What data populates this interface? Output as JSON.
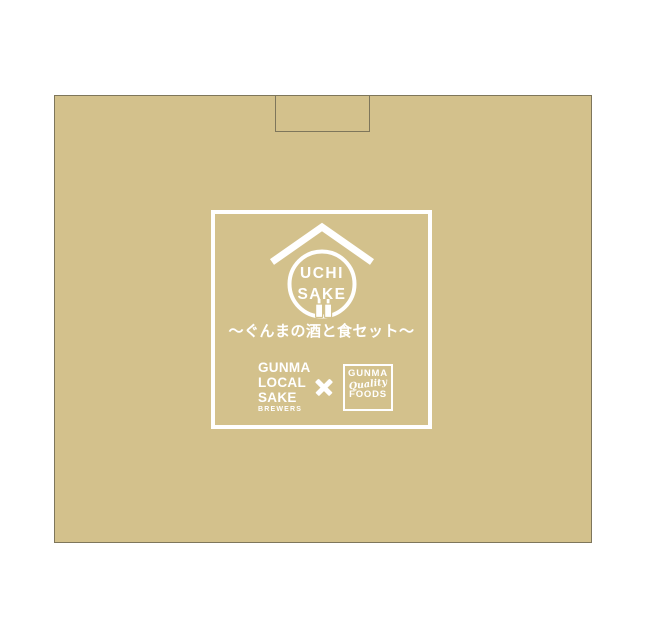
{
  "product": {
    "description": "Tan gift box with UCHI SAKE collaboration logo printed in white"
  },
  "emblem": {
    "line1": "UCHI",
    "line2": "SAKE"
  },
  "subtitle": "〜ぐんまの酒と食セット〜",
  "brand": {
    "line1": "GUNMA",
    "line2": "LOCAL",
    "line3": "SAKE",
    "line4": "BREWERS"
  },
  "collab": {
    "mark": "×"
  },
  "badge": {
    "line1": "GUNMA",
    "line2": "Quality",
    "line3": "FOODS"
  },
  "icons": {
    "roof": "house-roof-icon",
    "bottles": "sake-bottles-icon",
    "x": "collab-x-icon"
  },
  "colors": {
    "page_bg": "#ffffff",
    "box_fill": "#d3c18c",
    "box_border": "#7e765b",
    "print_white": "#ffffff"
  }
}
